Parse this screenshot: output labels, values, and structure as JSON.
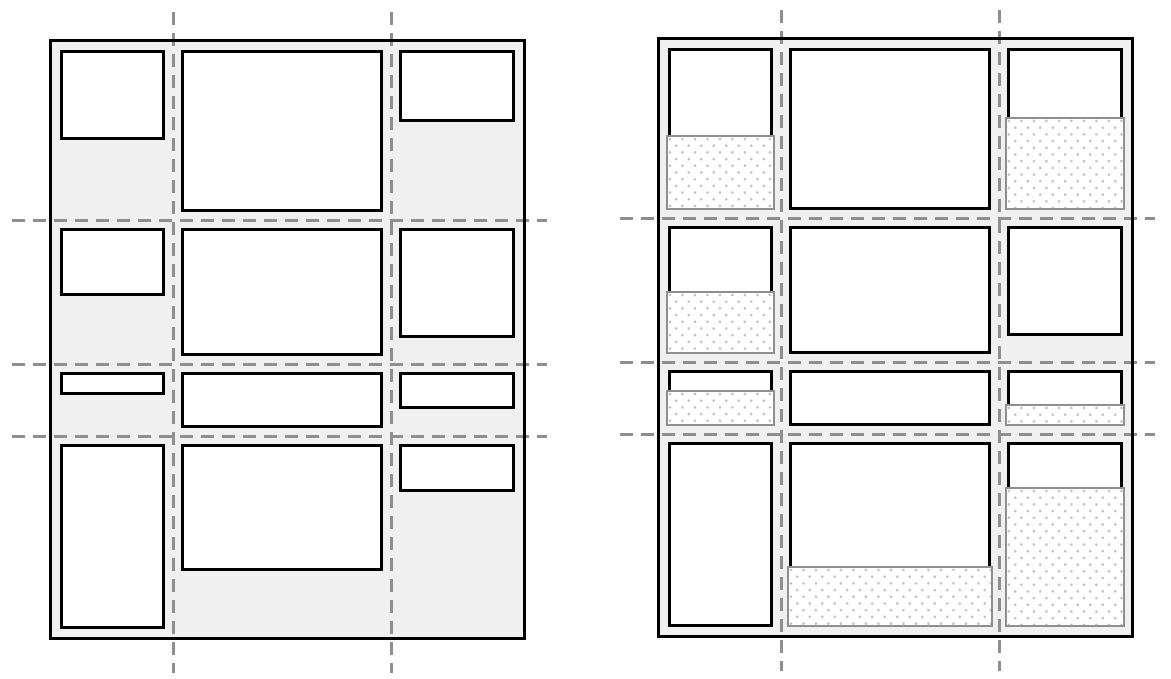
{
  "diagram": {
    "kind": "grid-alignment-illustration",
    "figure_count": 2
  },
  "colors": {
    "page_bg": "#ffffff",
    "container_fill": "#f0f0f0",
    "container_border": "#000000",
    "item_fill": "#ffffff",
    "item_border": "#000000",
    "grid_line": "#8f8f8f",
    "stretch_border": "#8f8f8f",
    "stretch_dots": "#c2c2c2"
  },
  "grid": {
    "width": 477,
    "height": 601,
    "border": 3,
    "cell_padding": 8,
    "col_bounds": [
      0,
      121,
      339,
      471
    ],
    "row_bounds": [
      0,
      178,
      322,
      394,
      595
    ],
    "dash_thickness": 3,
    "dash_overhang": {
      "left": 37,
      "right": 21,
      "top": 27,
      "bottom": 33
    }
  },
  "figures": [
    {
      "id": "natural",
      "x": 49,
      "y": 39,
      "show_stretch": false
    },
    {
      "id": "stretched",
      "x": 657,
      "y": 37,
      "show_stretch": true
    }
  ],
  "items": [
    {
      "row": 0,
      "col": 0,
      "height": 90,
      "stretches": true
    },
    {
      "row": 0,
      "col": 1,
      "height": "fill",
      "stretches": false
    },
    {
      "row": 0,
      "col": 2,
      "height": 72,
      "stretches": true
    },
    {
      "row": 1,
      "col": 0,
      "height": 68,
      "stretches": true
    },
    {
      "row": 1,
      "col": 1,
      "height": "fill",
      "stretches": false
    },
    {
      "row": 1,
      "col": 2,
      "height": 110,
      "stretches": false
    },
    {
      "row": 2,
      "col": 0,
      "height": 23,
      "stretches": true
    },
    {
      "row": 2,
      "col": 1,
      "height": "fill",
      "stretches": false
    },
    {
      "row": 2,
      "col": 2,
      "height": 37,
      "stretches": true
    },
    {
      "row": 3,
      "col": 0,
      "height": "fill",
      "stretches": false
    },
    {
      "row": 3,
      "col": 1,
      "height": 127,
      "stretches": true
    },
    {
      "row": 3,
      "col": 2,
      "height": 48,
      "stretches": true
    }
  ]
}
